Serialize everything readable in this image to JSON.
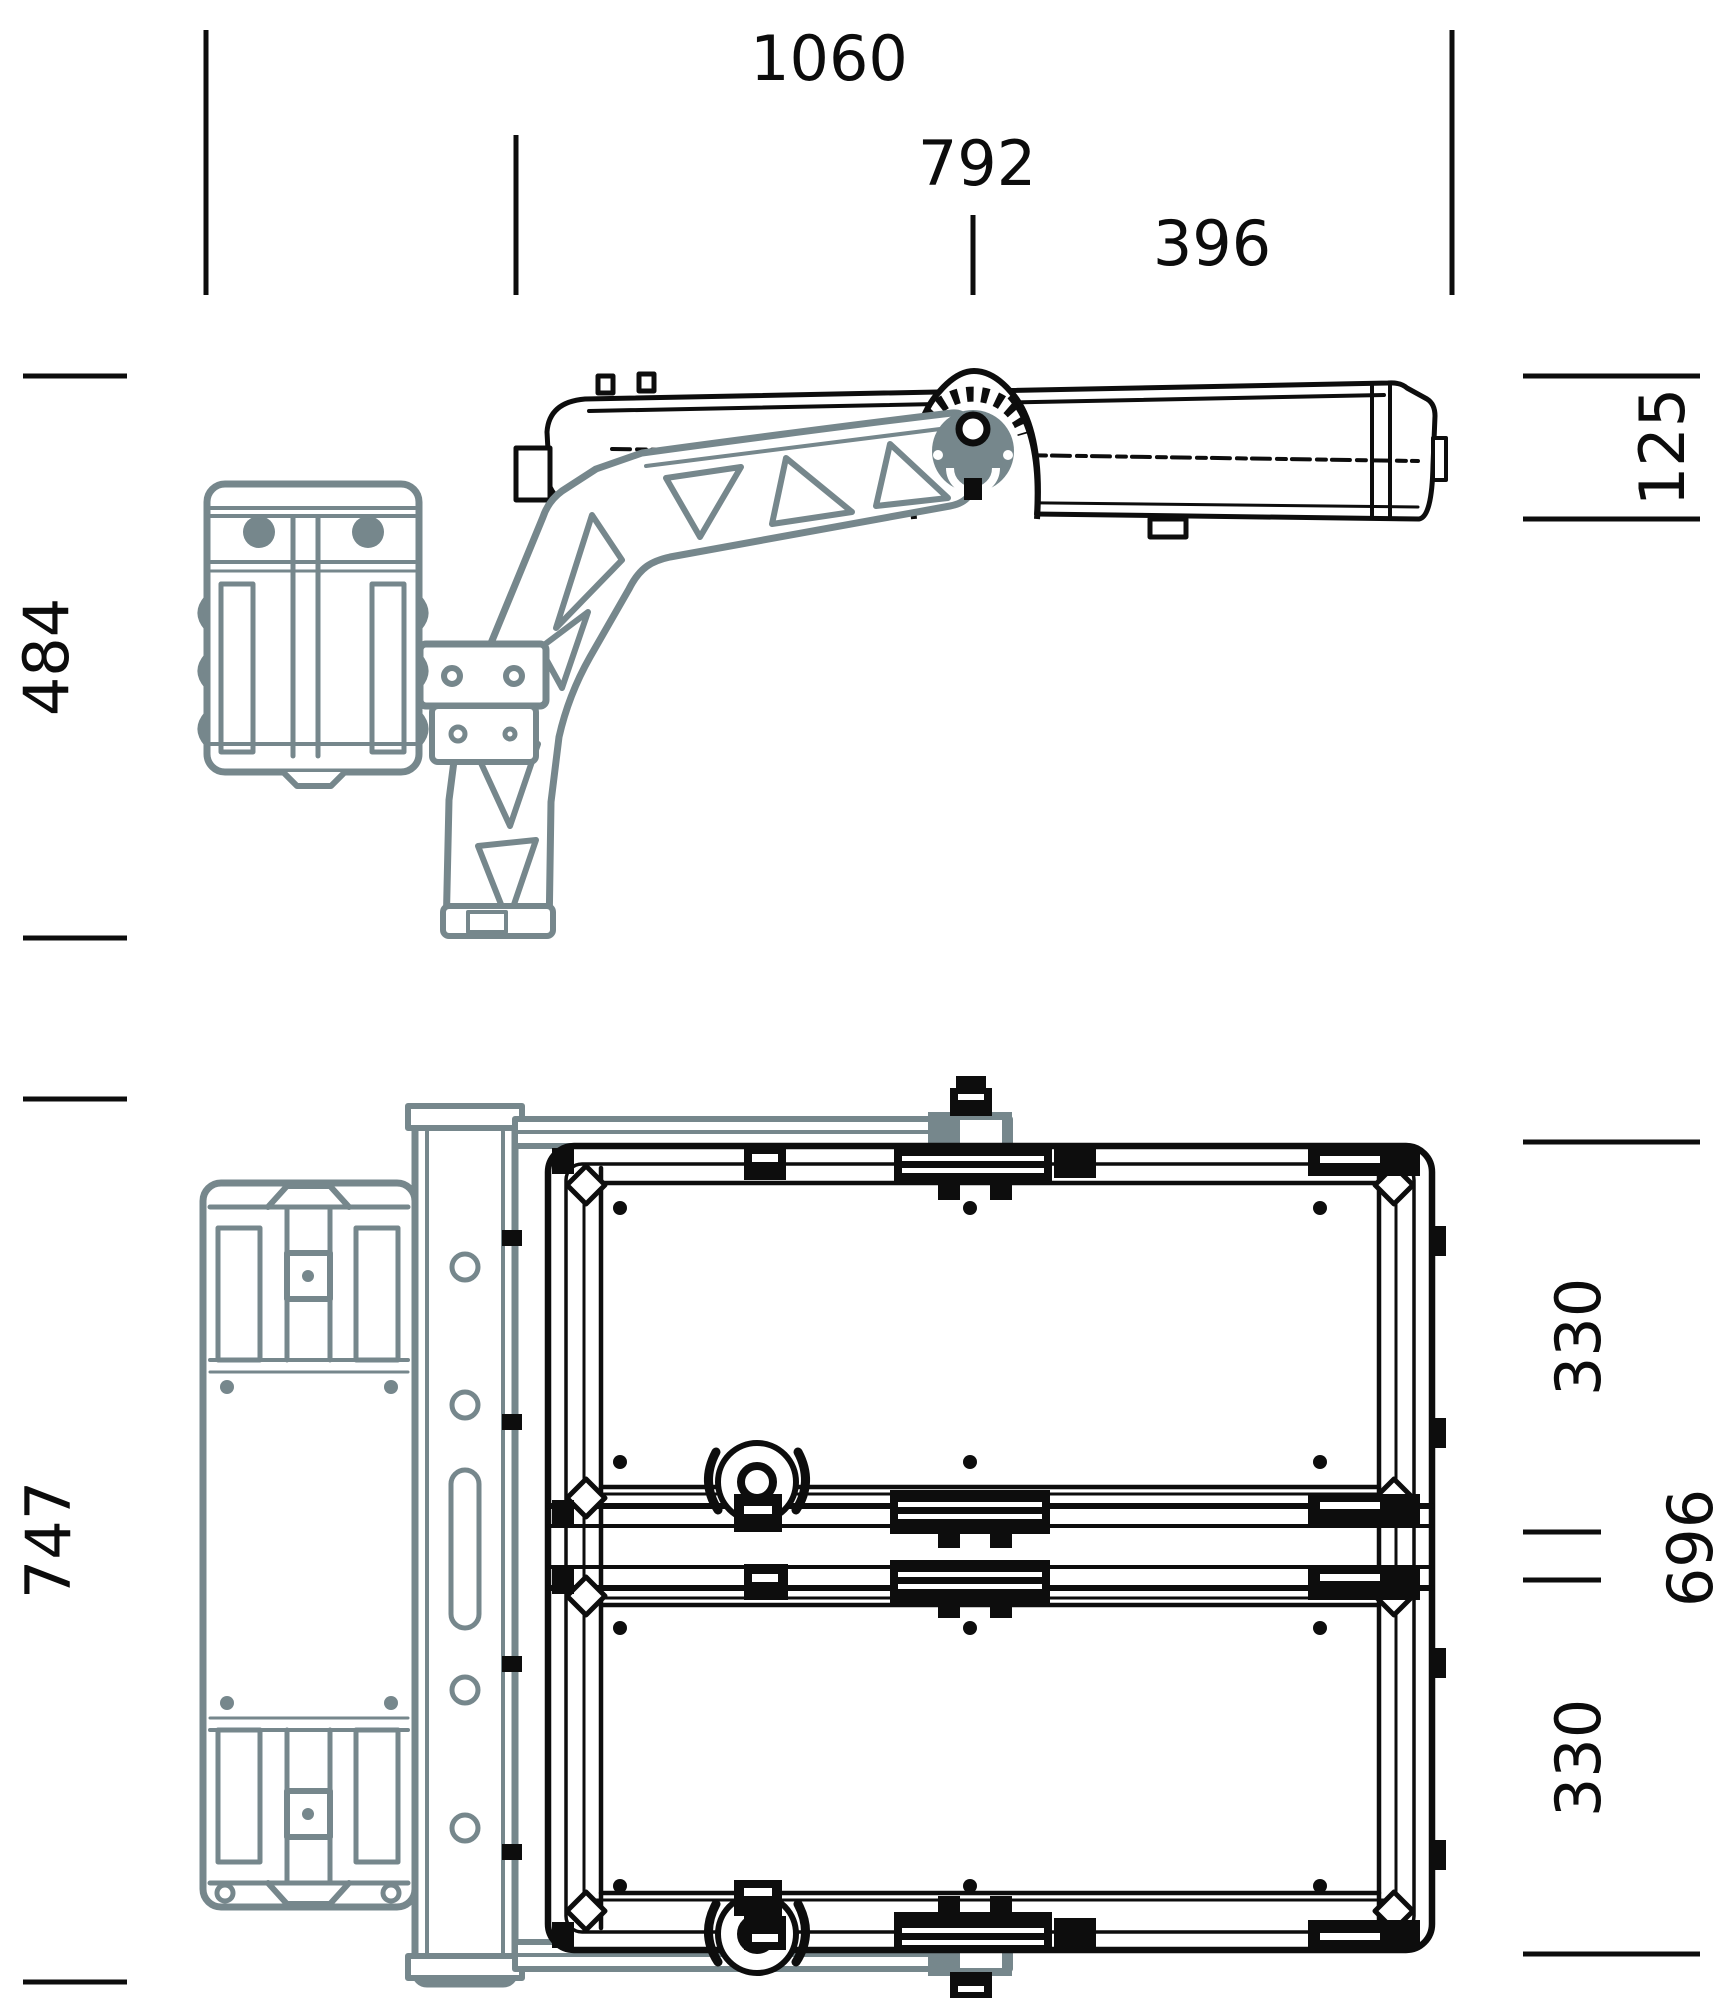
{
  "drawing": {
    "type": "engineering-dimension-drawing",
    "subject": "floodlight-luminaire-with-mounting-bracket",
    "views": {
      "top_view_name": "side-view",
      "bottom_view_name": "back-view"
    },
    "dimensions": {
      "top": [
        {
          "value": "1060"
        },
        {
          "value": "792"
        },
        {
          "value": "396"
        }
      ],
      "left": [
        {
          "value": "484"
        },
        {
          "value": "747"
        }
      ],
      "side_right": [
        {
          "value": "125"
        }
      ],
      "back_right": [
        {
          "value": "330"
        },
        {
          "value": "696"
        },
        {
          "value": "330"
        }
      ]
    },
    "colors": {
      "line": "#0d0d0d",
      "accent_gray": "#76878c",
      "background": "#ffffff"
    }
  }
}
